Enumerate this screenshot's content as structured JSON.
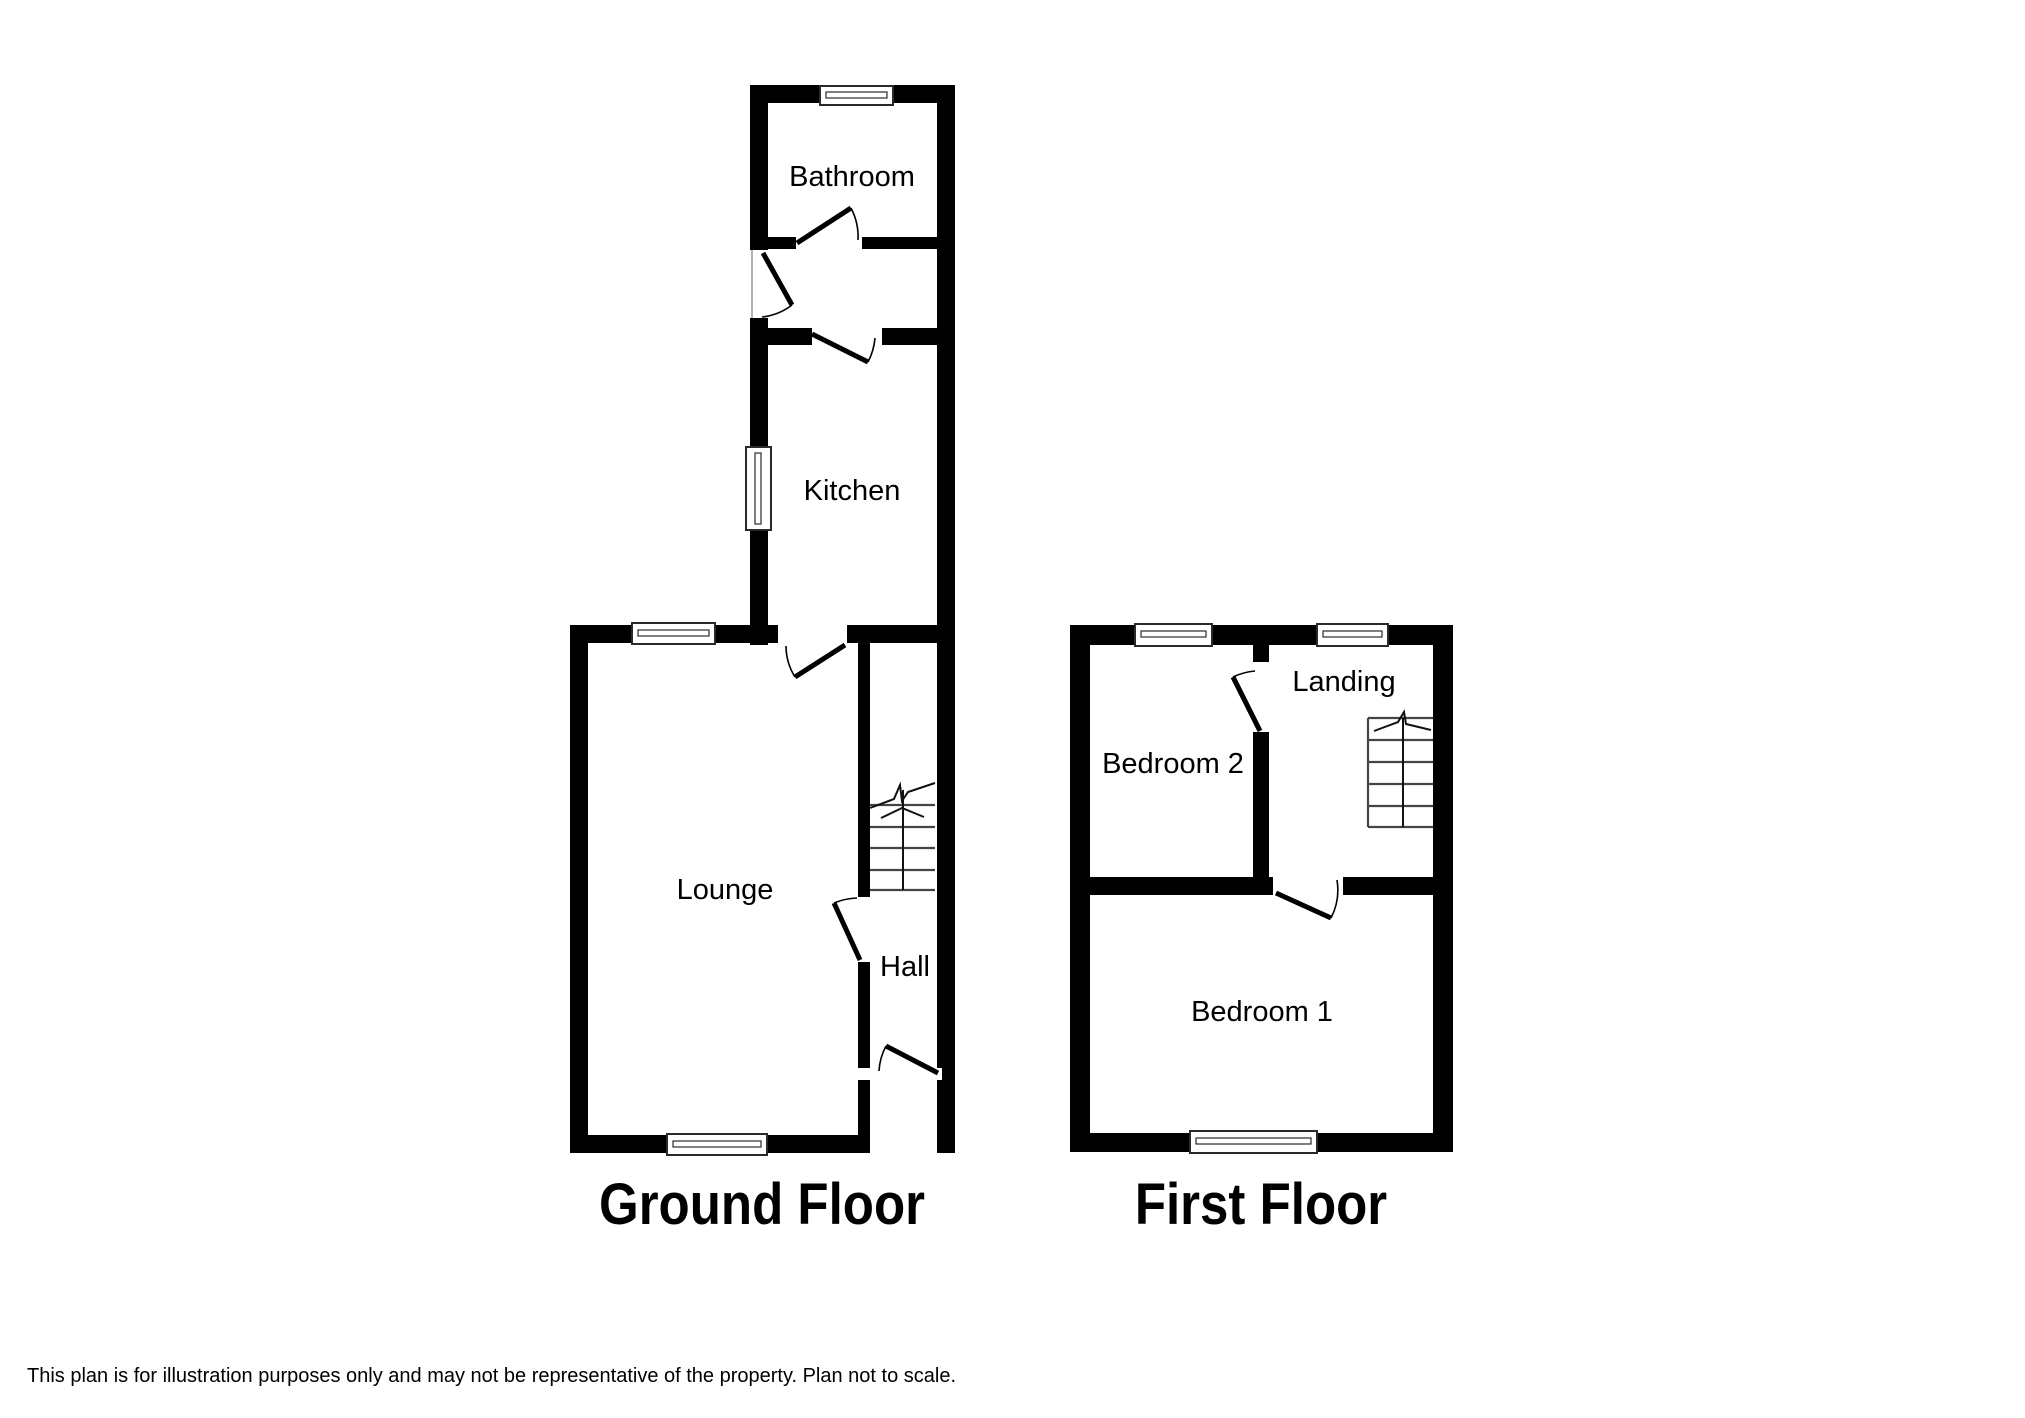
{
  "ground_floor": {
    "title": "Ground Floor",
    "rooms": {
      "bathroom": "Bathroom",
      "kitchen": "Kitchen",
      "lounge": "Lounge",
      "hall": "Hall"
    }
  },
  "first_floor": {
    "title": "First Floor",
    "rooms": {
      "bedroom_2": "Bedroom 2",
      "landing": "Landing",
      "bedroom_1": "Bedroom 1"
    }
  },
  "footer": {
    "disclaimer": "This plan is for illustration purposes only and may not be representative of the property. Plan not to scale."
  },
  "colors": {
    "wall": "#000000",
    "background": "#ffffff",
    "stair_line": "#444444",
    "door": "#000000"
  }
}
